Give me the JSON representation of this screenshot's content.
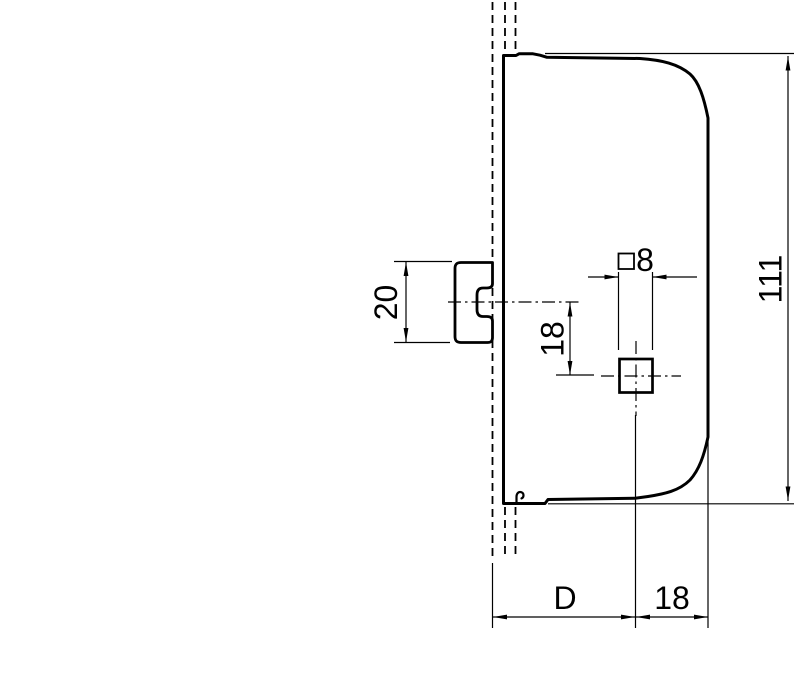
{
  "drawing": {
    "colors": {
      "line": "#000000",
      "background": "#ffffff"
    },
    "dimensions": {
      "knob_diameter": {
        "label": "20"
      },
      "spindle_vertical_offset": {
        "label": "18"
      },
      "spindle_square": {
        "symbol": "□",
        "label": "8"
      },
      "case_height": {
        "label": "111"
      },
      "backset": {
        "label": "D"
      },
      "spindle_to_case_back": {
        "label": "18"
      }
    }
  }
}
